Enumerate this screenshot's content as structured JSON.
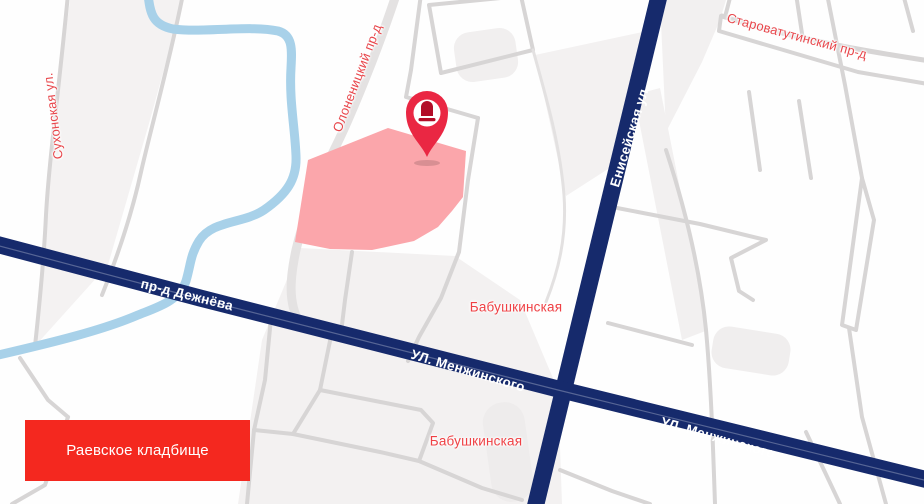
{
  "map": {
    "place": {
      "label": "Раевское кладбище"
    },
    "marker": {
      "icon": "cemetery-pin-icon"
    },
    "streets": {
      "sukhonskaya": "Сухонская ул.",
      "olonenitsky": "Олоненицкий пр-д",
      "starovatutinsky": "Староватутинский пр-д",
      "yeniseyskaya": "Енисейская ул.",
      "dezhnyova": "пр-д Дежнёва",
      "menzhinskogo": "УЛ. Менжинского"
    },
    "districts": {
      "babushkinskaya": "Бабушкинская"
    },
    "colors": {
      "major_road": "#162a6c",
      "minor_road": "#d7d5d5",
      "river": "#a8d1e9",
      "cemetery_area": "#fba6ab",
      "pin": "#ea2743",
      "pin_glyph": "#b30d28",
      "street_label_red": "#e8464b",
      "metro_label_red": "#ef4145",
      "place_box_red": "#f4281f"
    }
  }
}
